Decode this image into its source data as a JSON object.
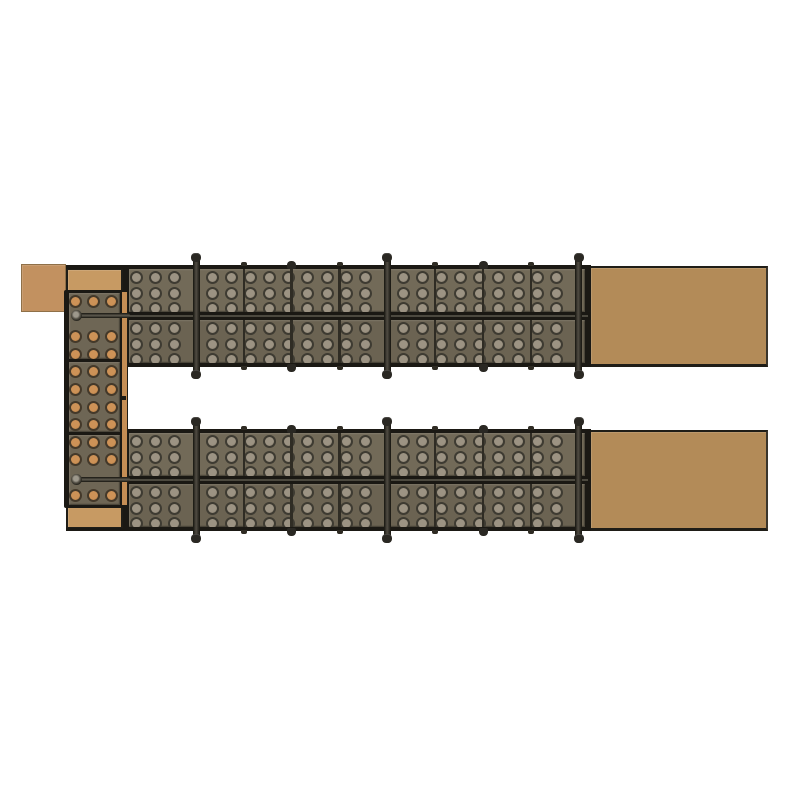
{
  "page": {
    "background": "#ffffff"
  },
  "figure": {
    "title": "Modular steel formwork assembly with perforated panels and timber infill blocks - plan view render",
    "canvas": {
      "width": 800,
      "height": 800,
      "background": "#ffffff"
    },
    "palette": {
      "frame": "#1b1914",
      "joint": "#2f2c24",
      "band": "#1a1813",
      "face_a": "#726a58",
      "face_b": "#6b6352",
      "face_col": "#6e6655",
      "hole_fill": "#9c9383",
      "hole_edge": "#7f7666",
      "hole_ring": "#3e3b32",
      "hole_tan_fill": "#cd9257",
      "hole_tan_edge": "#a8733d",
      "hole_tan_ring": "#44392a",
      "timber_main": "#b38b58",
      "timber_light": "#c79a63",
      "timber_pale": "#c29160",
      "timber_strip": "#c58e55",
      "timber_edge_soft": "#8f7048",
      "timber_edge_dark": "#1f1d17",
      "timber_end_edge": "#3a352c",
      "rod_dark": "#16150f",
      "rod_mid": "#504c43",
      "rod_cap": "#2a2823",
      "rod_light": "#5e5a4f",
      "washer_hi": "#9d988c",
      "washer_mid": "#555147"
    },
    "beams": {
      "x": 123,
      "width": 467.5,
      "tops": [
        265,
        429
      ],
      "height": 102,
      "band_height": 4,
      "mid_band": {
        "offset": 47,
        "height": 8
      },
      "faces": {
        "x": 129,
        "width": 456,
        "height": 43,
        "offsets": [
          4,
          55
        ]
      },
      "holes": {
        "col_start": 136,
        "col_step": 19.1,
        "col_count": 24,
        "row_offsets": [
          8,
          24,
          39.5
        ],
        "diameter": 13,
        "skip_margin": 10
      },
      "joints": {
        "xs": [
          243.8,
          291.7,
          339.5,
          435.2,
          483,
          530.8
        ],
        "width": 2.6
      },
      "edge_extensions": [
        {
          "x": 66,
          "y": 265,
          "width": 57,
          "height": 3.5
        },
        {
          "x": 66,
          "y": 527.5,
          "width": 57,
          "height": 3.5
        }
      ]
    },
    "column": {
      "frame": {
        "x": 64,
        "y": 290,
        "width": 59.5,
        "height": 217.5
      },
      "faces": {
        "x": 68.5,
        "width": 51.5,
        "segments": [
          [
            292.5,
            66
          ],
          [
            361.5,
            70
          ],
          [
            434.5,
            70.5
          ]
        ]
      },
      "holes": {
        "cols": [
          75.5,
          93.5,
          111.5
        ],
        "rows": [
          301.5,
          336.7,
          354.3,
          371.9,
          389.5,
          407.1,
          424.7,
          442.3,
          459.9,
          495.1
        ],
        "diameter": 13
      },
      "joints": {
        "ys": [
          358.5,
          431.5
        ],
        "height": 3
      },
      "strip": {
        "x": 121.5,
        "y": 292,
        "width": 6,
        "height": 213
      },
      "strip_notch": {
        "x": 121.8,
        "y": 395.5,
        "width": 4.2,
        "height": 4.5
      }
    },
    "timber_blocks": [
      {
        "id": "corner-left",
        "x": 21,
        "y": 263.5,
        "width": 45,
        "height": 48.5,
        "fill": "timber_pale",
        "border": "soft"
      },
      {
        "id": "cap-top",
        "x": 66,
        "y": 268,
        "width": 57,
        "height": 24.5,
        "fill": "timber_light",
        "border": "dark"
      },
      {
        "id": "cap-bottom",
        "x": 66,
        "y": 504.5,
        "width": 57,
        "height": 24.5,
        "fill": "timber_light",
        "border": "dark"
      },
      {
        "id": "right-top",
        "x": 590.5,
        "y": 265.5,
        "width": 177,
        "height": 101.5,
        "fill": "timber_main",
        "border": "beam-end"
      },
      {
        "id": "right-bottom",
        "x": 590.5,
        "y": 429.5,
        "width": 177,
        "height": 101.5,
        "fill": "timber_main",
        "border": "beam-end"
      }
    ],
    "tie_rods": {
      "extensions": [
        {
          "x": 78,
          "y": 312.6
        },
        {
          "x": 78,
          "y": 476.6
        }
      ],
      "ext_width": 52,
      "ext_height": 5.2,
      "washers": [
        {
          "cx": 76.5,
          "cy": 315.2
        },
        {
          "cx": 76,
          "cy": 479.2
        }
      ],
      "washer_diameter": 11
    },
    "hardware": {
      "rods": {
        "xs": [
          196,
          387.3,
          578.7
        ],
        "body_width": 7,
        "extend": 12,
        "cap_width": 10,
        "cap_height": 9
      },
      "nubs": {
        "xs": [
          291.7,
          483
        ],
        "width": 9,
        "height": 8
      },
      "ticks": {
        "xs": [
          243.8,
          339.5,
          435.2,
          530.8
        ],
        "width": 6,
        "height": 4.2
      }
    }
  }
}
